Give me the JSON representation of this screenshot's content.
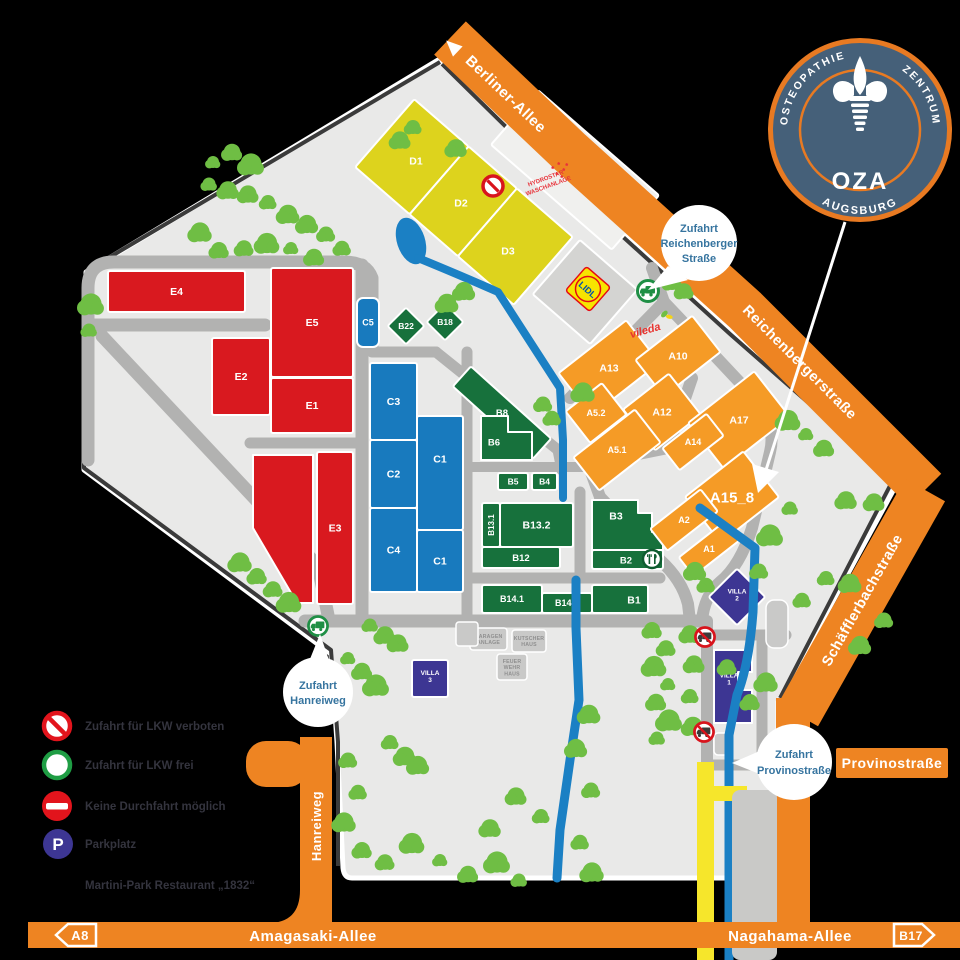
{
  "streets": {
    "berliner": "Berliner-Allee",
    "reichenberger": "Reichenbergerstraße",
    "schaefflerbach": "Schäfflerbachstraße",
    "hanreiweg": "Hanreiweg",
    "provino": "Provinostraße",
    "amagasaki": "Amagasaki-Allee",
    "nagahama": "Nagahama-Allee",
    "a8": "A8",
    "b17": "B17"
  },
  "entrances": [
    {
      "id": "reichenberger",
      "lines": [
        "Zufahrt",
        "Reichenberger",
        "Straße"
      ]
    },
    {
      "id": "hanreiweg",
      "lines": [
        "Zufahrt",
        "Hanreiweg"
      ]
    },
    {
      "id": "provinostrasse",
      "lines": [
        "Zufahrt",
        "Provinostraße"
      ]
    }
  ],
  "badge": {
    "arc_top_left": "OSTEOPATHIE",
    "arc_top_right": "ZENTRUM",
    "center": "OZA",
    "arc_bottom": "AUGSBURG"
  },
  "legend": [
    {
      "icon": "no-trucks-icon",
      "label": "Zufahrt für LKW verboten"
    },
    {
      "icon": "trucks-allowed-icon",
      "label": "Zufahrt für LKW frei"
    },
    {
      "icon": "no-through-icon",
      "label": "Keine Durchfahrt möglich"
    },
    {
      "icon": "parking-icon",
      "label": "Parkplatz"
    },
    {
      "icon": "",
      "label": "Martini-Park Restaurant „1832“"
    }
  ],
  "pois": {
    "hydrostar_lines": [
      "HYDROSTAR",
      "WASCHANLAGE"
    ],
    "lidl": "LIDL",
    "vileda": "vileda"
  },
  "colors": {
    "road_orange": "#ee8422",
    "building_red": "#d9191f",
    "building_blue": "#187abe",
    "building_green": "#17713c",
    "building_orange": "#f59b26",
    "building_yellow": "#ddd31d",
    "building_purple": "#3d3693",
    "water": "#1b80c4",
    "tree": "#6fbe44",
    "map_bg": "#e9e9e8",
    "road_gray": "#b2b2b1",
    "dark_road": "#3b3b3b",
    "badge_blue": "#456079",
    "badge_orange": "#e87a22",
    "sign_red": "#d8141c",
    "sign_green": "#1f8f45",
    "market": "#f0f0ee",
    "gray_building": "#cdcdcb"
  },
  "buildings": [
    {
      "id": "e4",
      "label": "E4",
      "group": "red",
      "rect": [
        108,
        271,
        137,
        41
      ]
    },
    {
      "id": "e5",
      "label": "E5",
      "group": "red",
      "rect": [
        271,
        268,
        82,
        109
      ]
    },
    {
      "id": "e2",
      "label": "E2",
      "group": "red",
      "rect": [
        212,
        338,
        58,
        77
      ]
    },
    {
      "id": "e1",
      "label": "E1",
      "group": "red",
      "rect": [
        271,
        378,
        82,
        55
      ]
    },
    {
      "id": "e3",
      "label": "E3",
      "group": "red",
      "rect": [
        317,
        452,
        36,
        152
      ]
    },
    {
      "id": "e3-annex",
      "label": "",
      "group": "red",
      "poly": [
        [
          253,
          455
        ],
        [
          313,
          455
        ],
        [
          313,
          603
        ],
        [
          297,
          603
        ],
        [
          253,
          528
        ]
      ]
    },
    {
      "id": "c5",
      "label": "C5",
      "group": "blue",
      "rect": [
        357,
        298,
        22,
        49
      ],
      "rx": 6,
      "ls": 9
    },
    {
      "id": "c3",
      "label": "C3",
      "group": "blue",
      "rect": [
        370,
        363,
        47,
        77
      ]
    },
    {
      "id": "c2",
      "label": "C2",
      "group": "blue",
      "rect": [
        370,
        440,
        47,
        68
      ]
    },
    {
      "id": "c4",
      "label": "C4",
      "group": "blue",
      "rect": [
        370,
        508,
        47,
        84
      ]
    },
    {
      "id": "c1-north",
      "label": "C1",
      "group": "blue",
      "rect": [
        417,
        416,
        46,
        114
      ],
      "labelAt": [
        440,
        459
      ]
    },
    {
      "id": "c1-south",
      "label": "C1",
      "group": "blue",
      "rect": [
        417,
        530,
        46,
        62
      ]
    },
    {
      "id": "b22",
      "label": "B22",
      "group": "green",
      "rect": [
        393,
        313,
        26,
        26
      ],
      "rot": 45,
      "ls": 8.5
    },
    {
      "id": "b18",
      "label": "B18",
      "group": "green",
      "rect": [
        432,
        309,
        26,
        26
      ],
      "rot": 45,
      "ls": 8.5
    },
    {
      "id": "b8",
      "label": "B8",
      "group": "green",
      "rect": [
        448,
        399,
        108,
        27
      ],
      "rot": 42,
      "ls": 9.5
    },
    {
      "id": "b6",
      "label": "B6",
      "group": "green",
      "poly": [
        [
          481,
          416
        ],
        [
          508,
          416
        ],
        [
          508,
          432
        ],
        [
          532,
          432
        ],
        [
          532,
          460
        ],
        [
          481,
          460
        ]
      ],
      "labelAt": [
        494,
        442
      ],
      "ls": 9.5
    },
    {
      "id": "b5",
      "label": "B5",
      "group": "green",
      "rect": [
        498,
        473,
        30,
        17
      ],
      "ls": 8.5
    },
    {
      "id": "b4",
      "label": "B4",
      "group": "green",
      "rect": [
        532,
        473,
        25,
        17
      ],
      "ls": 8.5
    },
    {
      "id": "b13-1",
      "label": "B13.1",
      "group": "green",
      "rect": [
        482,
        503,
        18,
        44
      ],
      "labelRot": -90,
      "ls": 8
    },
    {
      "id": "b13-2",
      "label": "B13.2",
      "group": "green",
      "rect": [
        500,
        503,
        73,
        44
      ]
    },
    {
      "id": "b12",
      "label": "B12",
      "group": "green",
      "rect": [
        482,
        547,
        78,
        21
      ],
      "ls": 9.5
    },
    {
      "id": "b3",
      "label": "B3",
      "group": "green",
      "poly": [
        [
          592,
          500
        ],
        [
          638,
          500
        ],
        [
          638,
          513
        ],
        [
          652,
          513
        ],
        [
          652,
          532
        ],
        [
          663,
          532
        ],
        [
          663,
          550
        ],
        [
          592,
          550
        ]
      ],
      "labelAt": [
        616,
        516
      ]
    },
    {
      "id": "b2",
      "label": "B2",
      "group": "green",
      "rect": [
        592,
        550,
        71,
        19
      ],
      "labelAt": [
        626,
        560
      ],
      "ls": 9.5
    },
    {
      "id": "b14-1",
      "label": "B14.1",
      "group": "green",
      "rect": [
        482,
        585,
        60,
        28
      ],
      "ls": 9
    },
    {
      "id": "b14-2",
      "label": "B14.2",
      "group": "green",
      "rect": [
        542,
        593,
        50,
        20
      ],
      "ls": 9
    },
    {
      "id": "b1",
      "label": "B1",
      "group": "green",
      "rect": [
        592,
        585,
        56,
        28
      ],
      "labelAt": [
        634,
        600
      ]
    },
    {
      "id": "a13",
      "label": "A13",
      "group": "orange",
      "rect": [
        566,
        341,
        86,
        54
      ],
      "rot": -38
    },
    {
      "id": "a10",
      "label": "A10",
      "group": "orange",
      "rect": [
        642,
        333,
        72,
        46
      ],
      "rot": -38
    },
    {
      "id": "a5-2",
      "label": "A5.2",
      "group": "orange",
      "rect": [
        573,
        393,
        46,
        40
      ],
      "rot": -38,
      "ls": 9
    },
    {
      "id": "a12",
      "label": "A12",
      "group": "orange",
      "rect": [
        633,
        386,
        58,
        52
      ],
      "rot": -38
    },
    {
      "id": "a17",
      "label": "A17",
      "group": "orange",
      "rect": [
        697,
        391,
        84,
        58
      ],
      "rot": -38
    },
    {
      "id": "a5-1",
      "label": "A5.1",
      "group": "orange",
      "rect": [
        578,
        429,
        78,
        42
      ],
      "rot": -38,
      "ls": 9
    },
    {
      "id": "a14",
      "label": "A14",
      "group": "orange",
      "rect": [
        665,
        428,
        56,
        28
      ],
      "rot": -38,
      "ls": 9
    },
    {
      "id": "a15-8",
      "label": "A15_8",
      "group": "orange",
      "rect": [
        695,
        468,
        74,
        58
      ],
      "rot": -38,
      "ls": 15
    },
    {
      "id": "a2",
      "label": "A2",
      "group": "orange",
      "rect": [
        652,
        506,
        64,
        28
      ],
      "rot": -38,
      "ls": 9
    },
    {
      "id": "a1",
      "label": "A1",
      "group": "orange",
      "rect": [
        680,
        537,
        58,
        24
      ],
      "rot": -38,
      "ls": 9
    },
    {
      "id": "d1",
      "label": "D1",
      "group": "yellow",
      "rect": [
        359,
        157,
        72,
        90
      ],
      "rot": 41,
      "ro": [
        464,
        202
      ],
      "labelAt": [
        416,
        161
      ]
    },
    {
      "id": "d2",
      "label": "D2",
      "group": "yellow",
      "rect": [
        431,
        157,
        64,
        90
      ],
      "rot": 41,
      "ro": [
        464,
        202
      ],
      "labelAt": [
        461,
        203
      ]
    },
    {
      "id": "d3",
      "label": "D3",
      "group": "yellow",
      "rect": [
        495,
        157,
        74,
        90
      ],
      "rot": 41,
      "ro": [
        464,
        202
      ],
      "labelAt": [
        508,
        251
      ]
    },
    {
      "id": "market-hall",
      "label": "",
      "group": "market",
      "rect": [
        495,
        134,
        160,
        72
      ],
      "rot": 41,
      "ro": [
        575,
        170
      ]
    },
    {
      "id": "lidl-building",
      "label": "",
      "group": "grayb",
      "rect": [
        547,
        256,
        76,
        72
      ],
      "rot": 41,
      "ro": [
        585,
        292
      ]
    },
    {
      "id": "villa-2",
      "label": "VILLA\n2",
      "group": "purple",
      "rect": [
        717,
        577,
        40,
        40
      ],
      "rot": 45,
      "ls": 6.5
    },
    {
      "id": "villa-1",
      "label": "VILLA\n1",
      "group": "purple",
      "poly": [
        [
          714,
          650
        ],
        [
          752,
          650
        ],
        [
          752,
          672
        ],
        [
          738,
          672
        ],
        [
          738,
          690
        ],
        [
          752,
          690
        ],
        [
          752,
          723
        ],
        [
          714,
          723
        ]
      ],
      "labelAt": [
        729,
        681
      ],
      "ls": 6.5
    },
    {
      "id": "villa-3",
      "label": "VILLA\n3",
      "group": "purple",
      "rect": [
        412,
        660,
        36,
        37
      ],
      "ls": 6.5
    }
  ],
  "small_buildings": [
    {
      "id": "garagen-anlage",
      "lines": [
        "GARAGEN",
        "ANLAGE"
      ],
      "rect": [
        470,
        628,
        37,
        22
      ]
    },
    {
      "id": "kutscher-haus",
      "lines": [
        "KUTSCHER",
        "HAUS"
      ],
      "rect": [
        512,
        630,
        34,
        22
      ]
    },
    {
      "id": "feuerwehr-haus",
      "lines": [
        "FEUER",
        "WEHR",
        "HAUS"
      ],
      "rect": [
        497,
        654,
        30,
        26
      ]
    },
    {
      "id": "annex",
      "lines": [],
      "rect": [
        456,
        622,
        22,
        24
      ]
    },
    {
      "id": "parking-villa2",
      "lines": [],
      "rect": [
        766,
        600,
        22,
        48
      ],
      "rx": 8
    },
    {
      "id": "small-hut",
      "lines": [],
      "rect": [
        714,
        733,
        16,
        22
      ],
      "rx": 4
    }
  ]
}
